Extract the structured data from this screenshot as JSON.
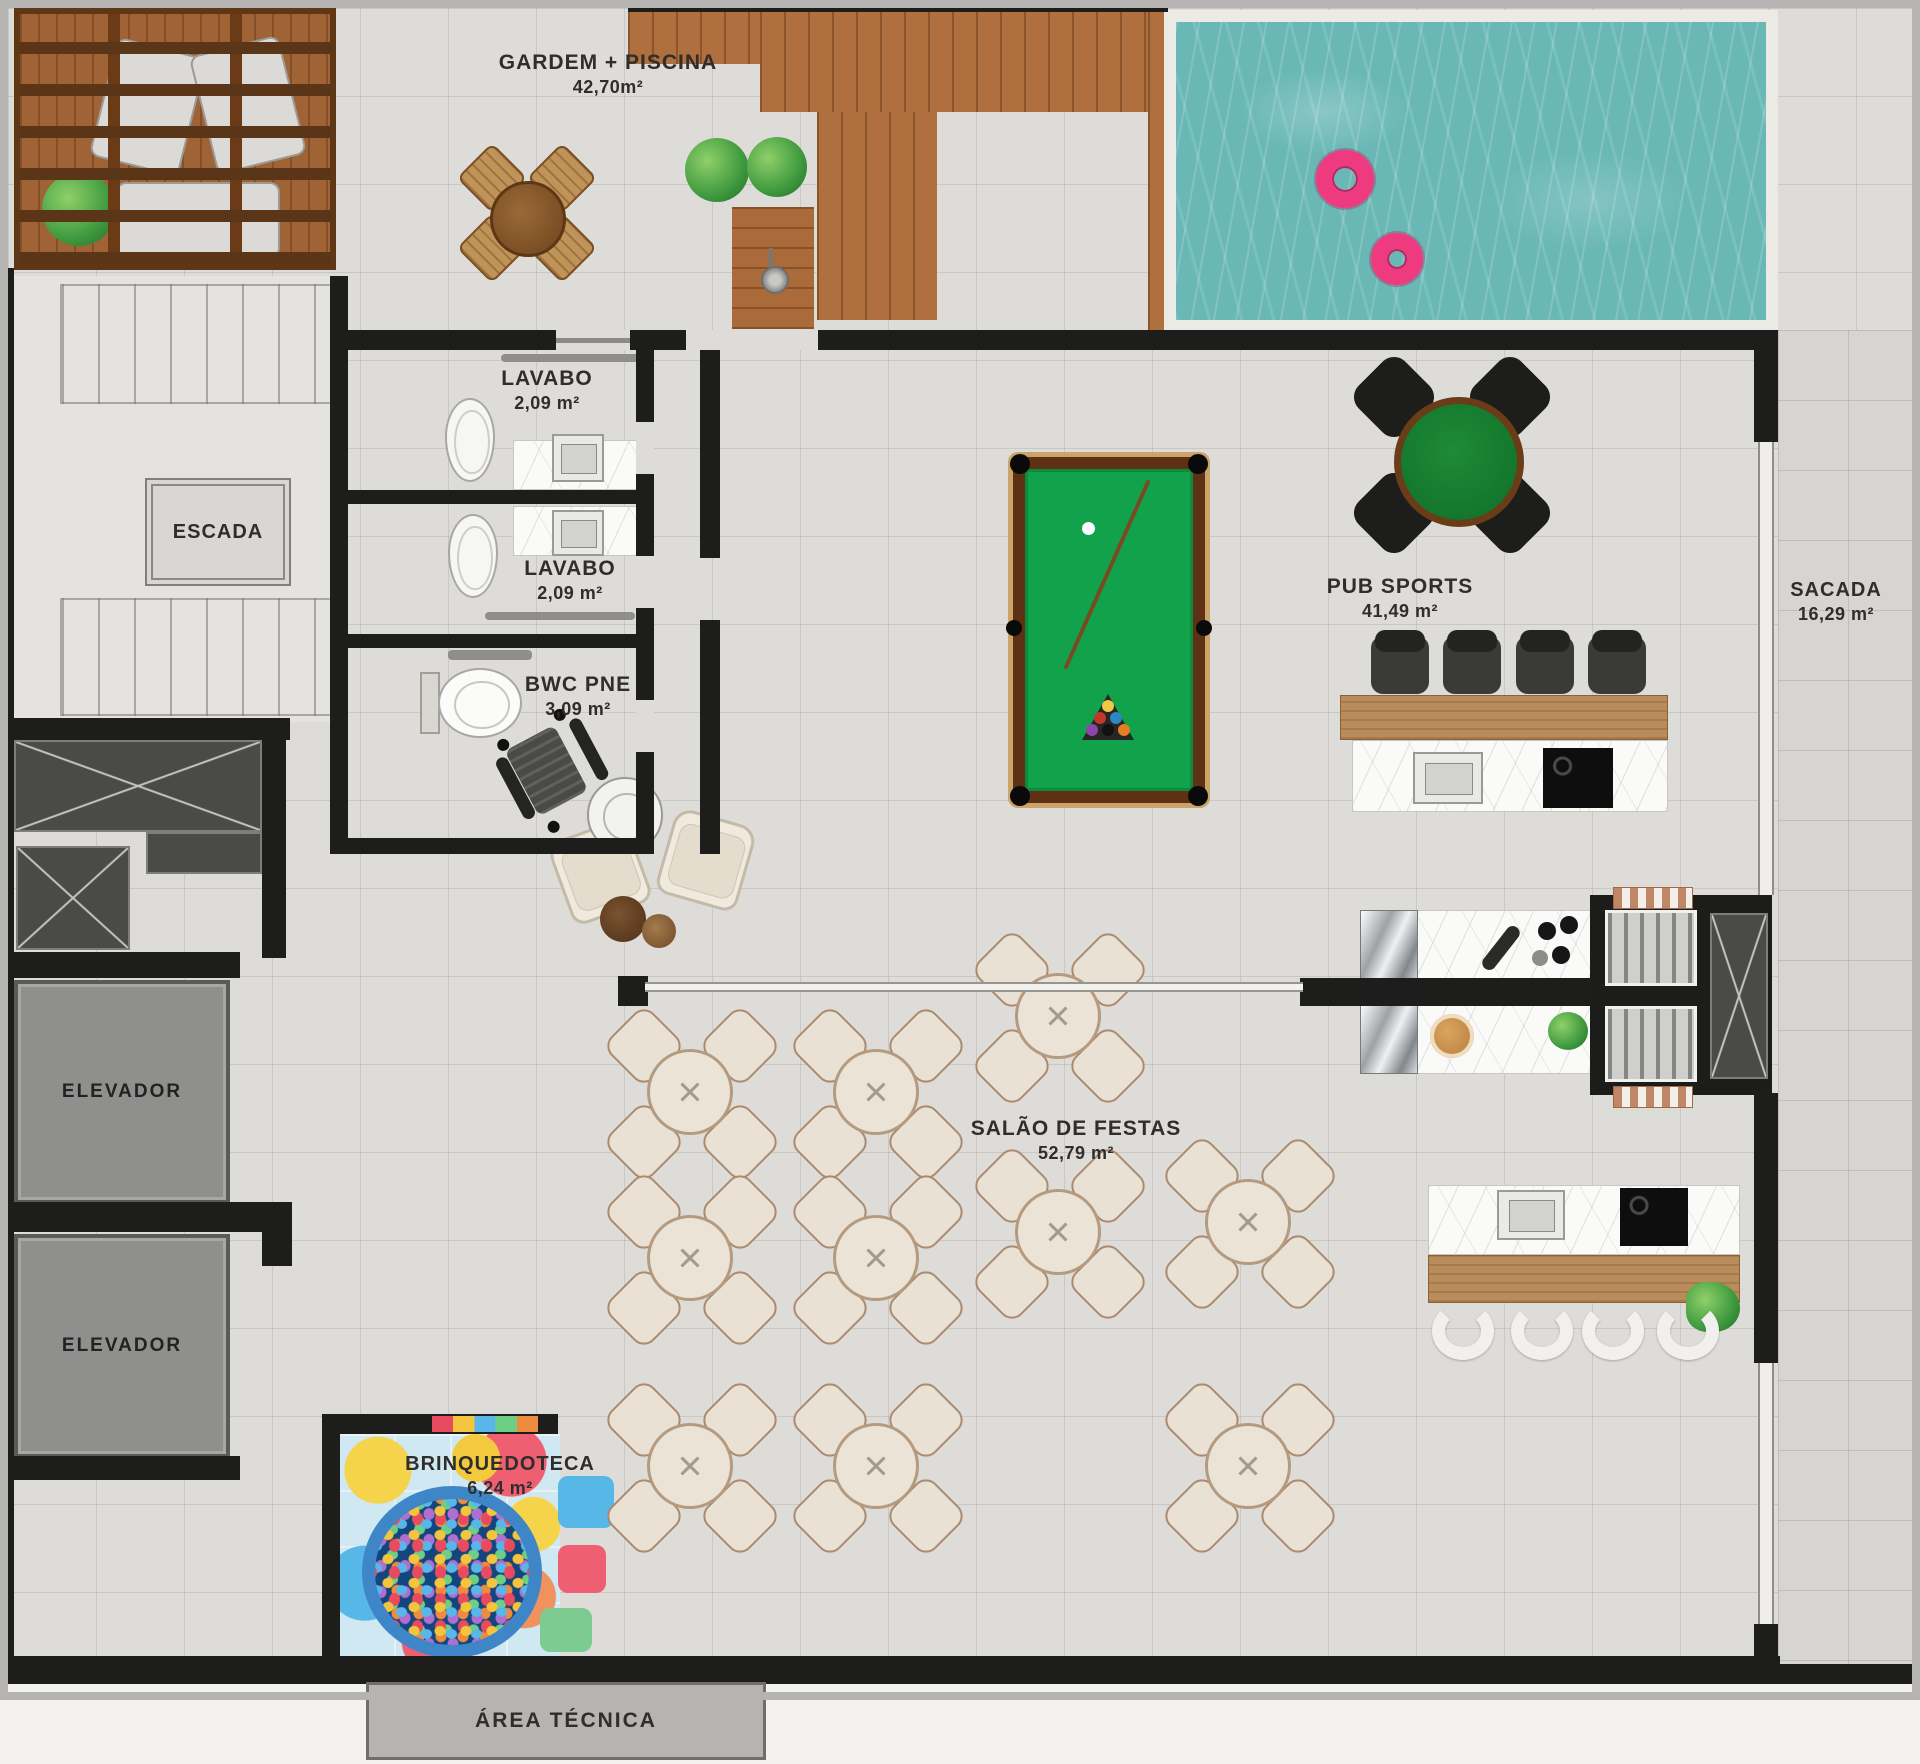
{
  "plan": {
    "rooms": {
      "gardem": {
        "label": "GARDEM + PISCINA",
        "area": "42,70m²"
      },
      "lavabo_1": {
        "label": "LAVABO",
        "area": "2,09 m²"
      },
      "lavabo_2": {
        "label": "LAVABO",
        "area": "2,09 m²"
      },
      "escada": {
        "label": "ESCADA"
      },
      "bwc_pne": {
        "label": "BWC PNE",
        "area": "3,09 m²"
      },
      "pub_sports": {
        "label": "PUB SPORTS",
        "area": "41,49 m²"
      },
      "sacada": {
        "label": "SACADA",
        "area": "16,29 m²"
      },
      "elevador_1": {
        "label": "ELEVADOR"
      },
      "elevador_2": {
        "label": "ELEVADOR"
      },
      "salao_de_festas": {
        "label": "SALÃO DE FESTAS",
        "area": "52,79 m²"
      },
      "brinquedoteca": {
        "label": "BRINQUEDOTECA",
        "area": "6,24 m²"
      },
      "area_tecnica": {
        "label": "ÁREA TÉCNICA"
      }
    },
    "colors": {
      "wall": "#1d1d1b",
      "floor": "#dedcd8",
      "pool_water": "#6ab8b6",
      "pool_float": "#ee3b80",
      "billiard_felt": "#12a24c",
      "deck_wood": "#b06f3e",
      "elevator_fill": "#8f8f8d"
    }
  }
}
